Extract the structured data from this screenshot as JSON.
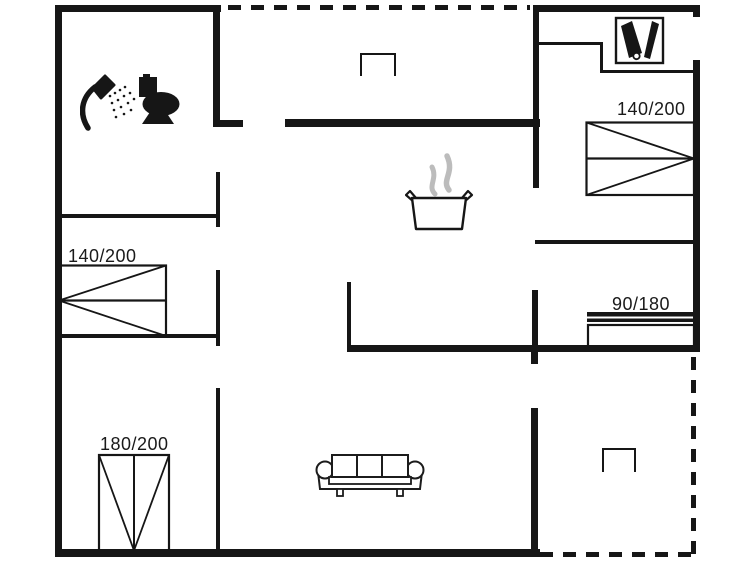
{
  "floor_plan": {
    "beds": [
      {
        "id": "bedroom-top-right",
        "size": "140/200"
      },
      {
        "id": "bedroom-left",
        "size": "140/200"
      },
      {
        "id": "bedroom-right-small",
        "size": "90/180"
      },
      {
        "id": "bedroom-bottom-left",
        "size": "180/200"
      }
    ],
    "colors": {
      "wall": "#161616",
      "steam": "#bcbcbc",
      "background": "#ffffff",
      "text": "#1a1a1a"
    },
    "icons": [
      "shower-icon",
      "toilet-icon",
      "cleaning-utility-icon",
      "cooking-pot-icon",
      "sofa-icon",
      "grill-icon",
      "terrace-table-icon"
    ]
  }
}
